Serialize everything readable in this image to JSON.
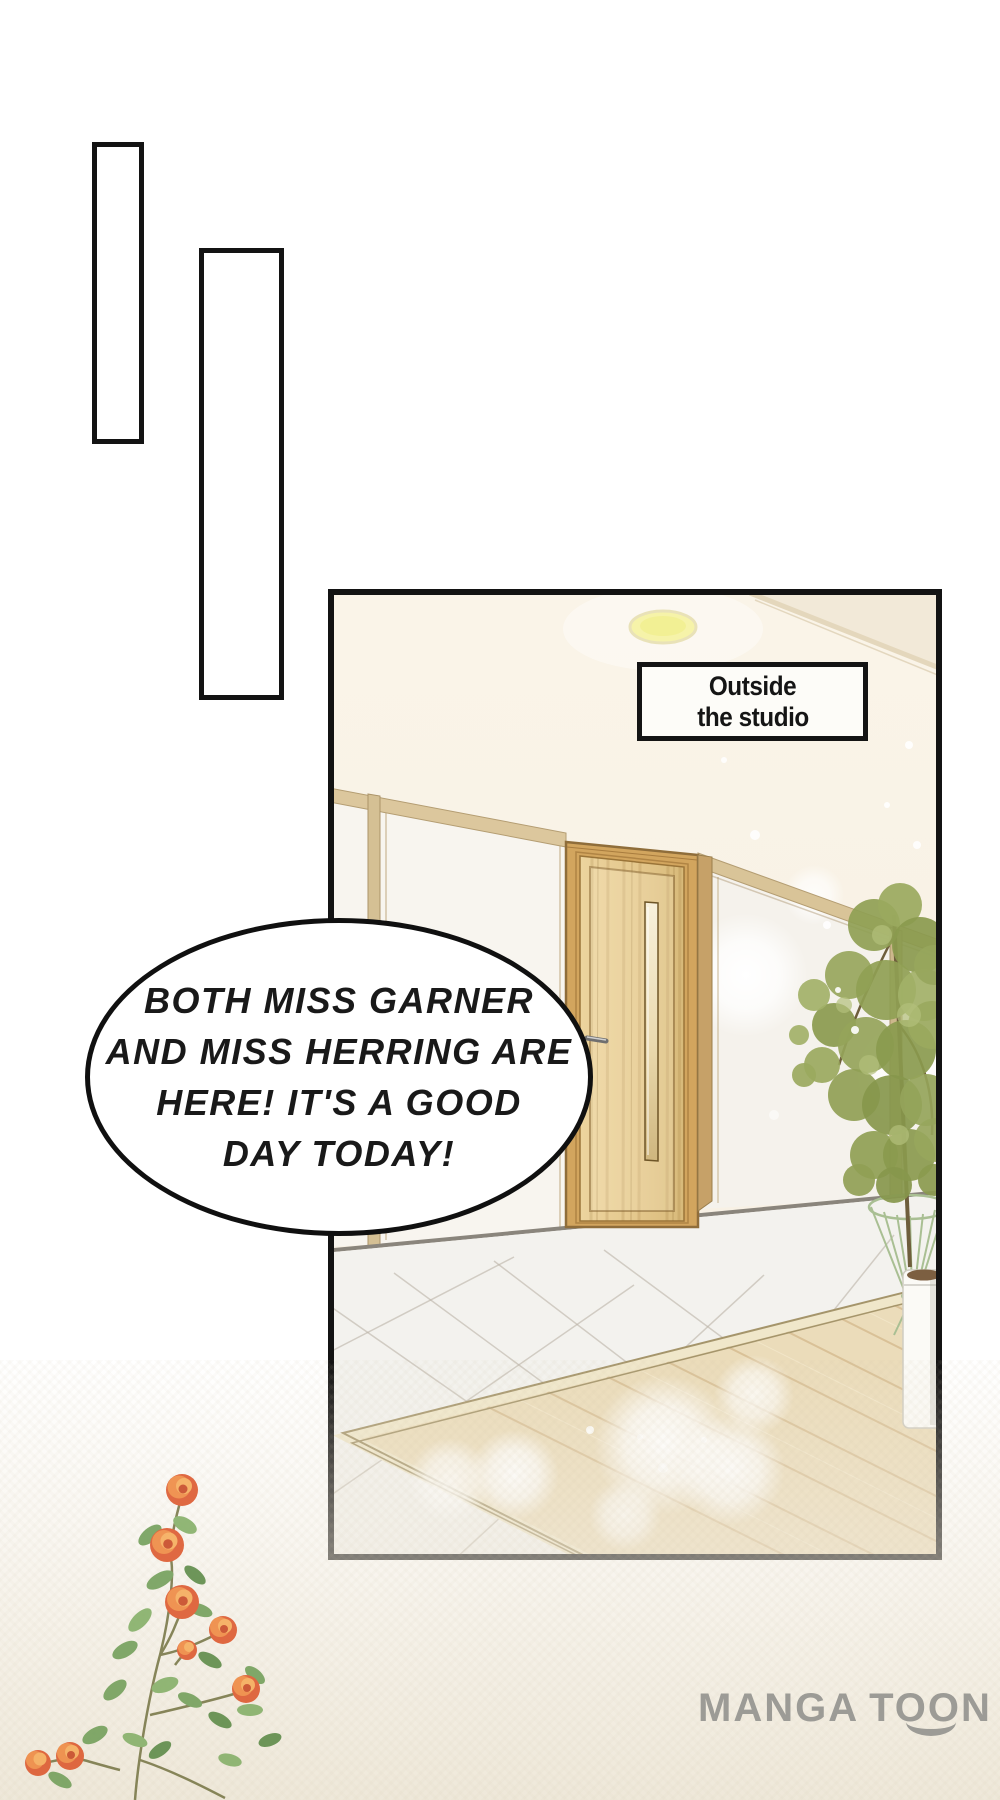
{
  "artwork": {
    "scene_label": {
      "line1": "Outside",
      "line2": "the studio"
    },
    "speech_bubble": {
      "line1": "BOTH MISS GARNER",
      "line2": "AND MISS HERRING ARE",
      "line3": "HERE! IT'S A GOOD",
      "line4": "DAY TODAY!"
    },
    "watermark": {
      "part1": "MANGA",
      "part2": "TOON"
    },
    "colors": {
      "panel_border": "#131313",
      "wall_cream": "#f8f2e6",
      "door_wood": "#e0c288",
      "rug_wood": "#ebdcba",
      "foliage_green": "#8fa054",
      "rose_orange": "#e66a3e",
      "logo_gray": "#9c9b96",
      "ceiling_light_yellow": "#f6f3a9"
    }
  }
}
